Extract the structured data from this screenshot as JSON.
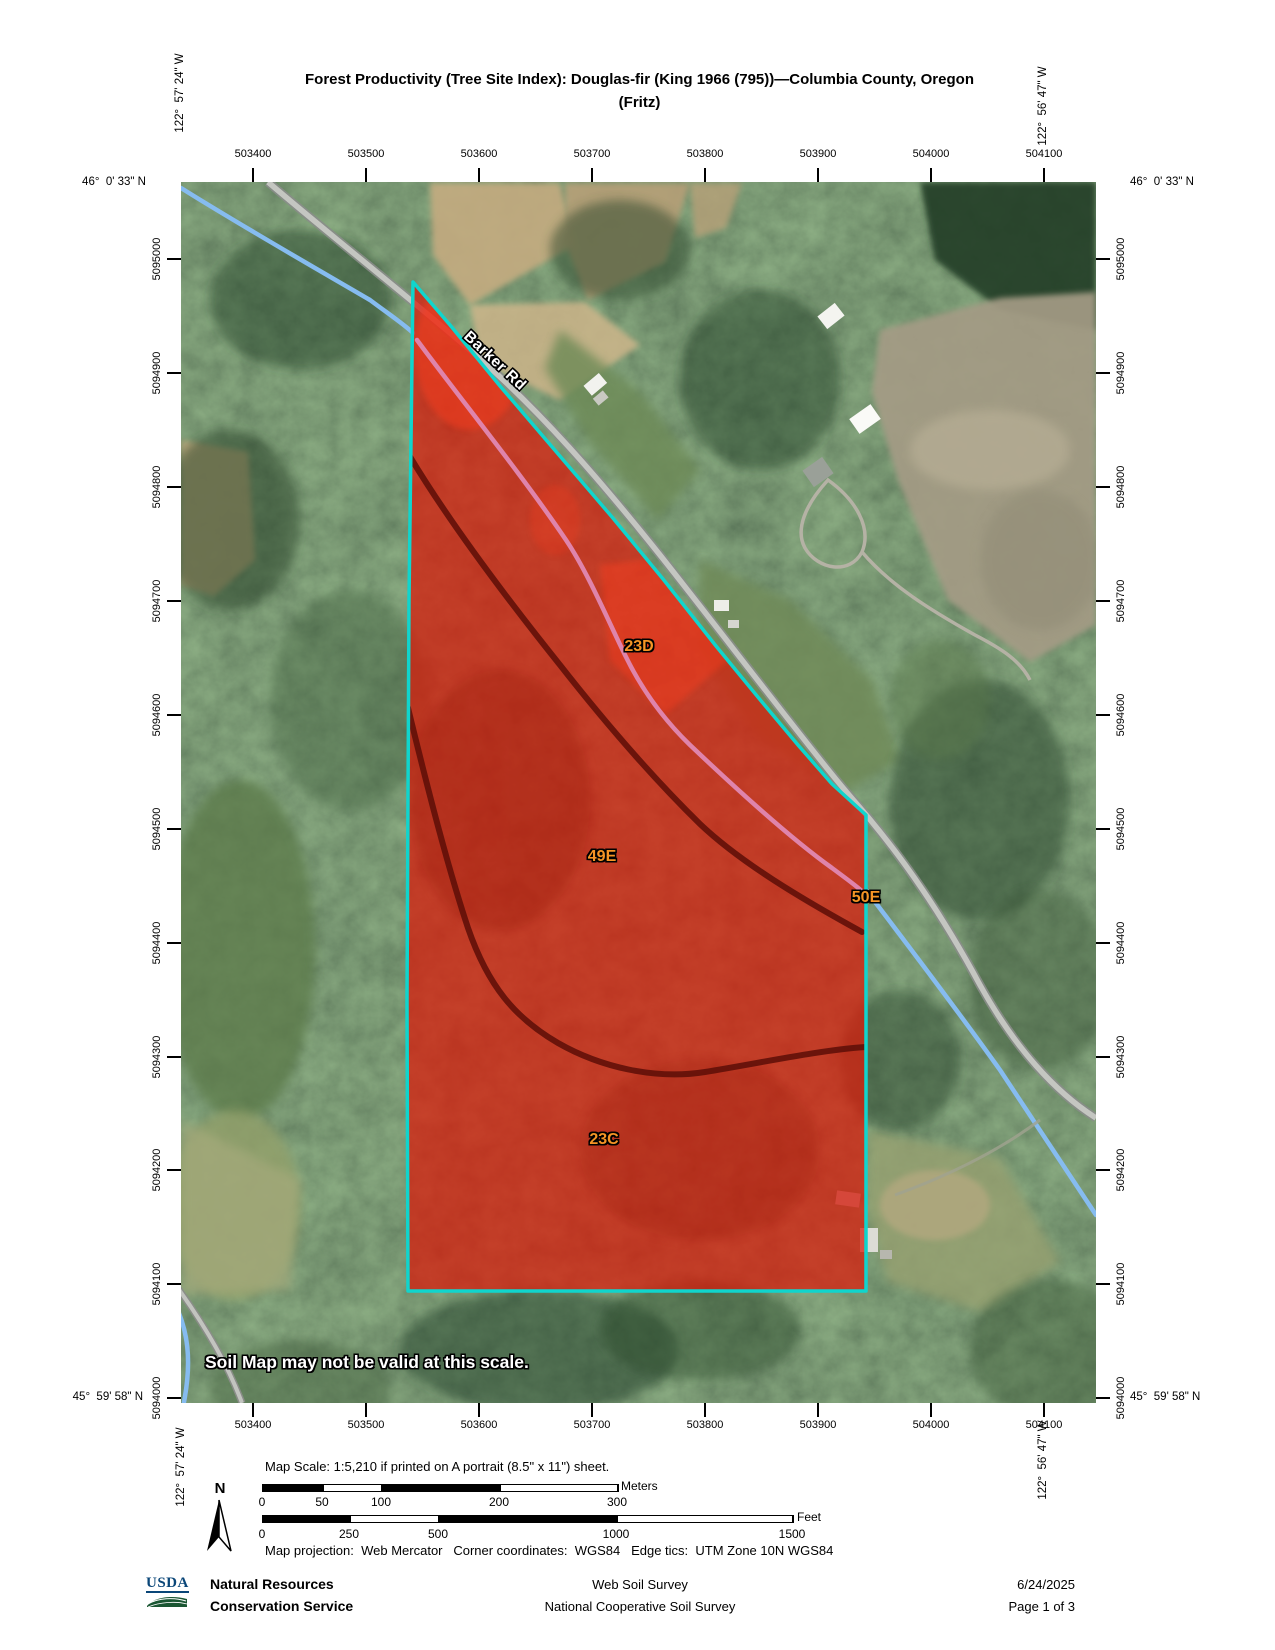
{
  "title": {
    "line1": "Forest Productivity (Tree Site Index): Douglas-fir (King 1966 (795))—Columbia County, Oregon",
    "line2": "(Fritz)"
  },
  "corner_coords": {
    "top_left_lon": "122°  57' 24\" W",
    "top_right_lon": "122°  56' 47\" W",
    "bottom_left_lon": "122°  57' 24\" W",
    "bottom_right_lon": "122°  56' 47\" W",
    "top_left_lat": "46°  0' 33\" N",
    "top_right_lat": "46°  0' 33\" N",
    "bottom_left_lat": "45°  59' 58\" N",
    "bottom_right_lat": "45°  59' 58\" N"
  },
  "axes": {
    "x_ticks": [
      "503400",
      "503500",
      "503600",
      "503700",
      "503800",
      "503900",
      "504000",
      "504100"
    ],
    "y_ticks": [
      "5095000",
      "5094900",
      "5094800",
      "5094700",
      "5094600",
      "5094500",
      "5094400",
      "5094300",
      "5094200",
      "5094100",
      "5094000"
    ]
  },
  "map": {
    "road_label": "Barker Rd",
    "warning": "Soil Map may not be valid at this scale.",
    "soil_units": [
      "23D",
      "49E",
      "50E",
      "23C"
    ],
    "colors": {
      "aoi_fill": "#dd1708",
      "aoi_border": "#10d5cd",
      "soil_boundary_pink": "#df84ab",
      "soil_boundary_dark": "#5e0f08",
      "soil_label": "#f59425",
      "stream": "#86bcf0",
      "road": "#c4c6c1"
    }
  },
  "scale": {
    "text": "Map Scale: 1:5,210 if printed on A portrait (8.5\" x 11\") sheet.",
    "meters": {
      "unit": "Meters",
      "ticks": [
        "0",
        "50",
        "100",
        "200",
        "300"
      ]
    },
    "feet": {
      "unit": "Feet",
      "ticks": [
        "0",
        "250",
        "500",
        "1000",
        "1500"
      ]
    },
    "projection": "Map projection:  Web Mercator   Corner coordinates:  WGS84   Edge tics:  UTM Zone 10N WGS84",
    "north": "N"
  },
  "footer": {
    "usda": "USDA",
    "agency_line1": "Natural Resources",
    "agency_line2": "Conservation Service",
    "center_line1": "Web Soil Survey",
    "center_line2": "National Cooperative Soil Survey",
    "date": "6/24/2025",
    "page": "Page 1 of 3"
  }
}
